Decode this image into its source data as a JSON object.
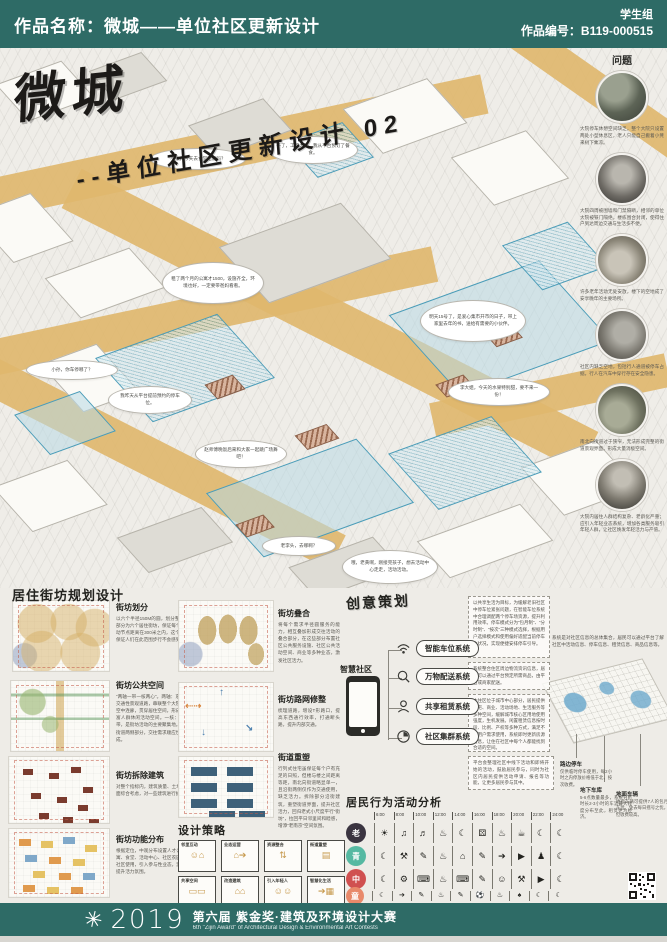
{
  "colors": {
    "header_teal": "#2e6b66",
    "road_tan": "#dfb76e",
    "axon_blue": "#4a9cb8",
    "roof_brown": "#9a6a50"
  },
  "header": {
    "title": "作品名称：微城——单位社区更新设计",
    "group": "学生组",
    "code": "作品编号：B119-000515"
  },
  "title_block": {
    "main": "微城",
    "sub": "--单位社区更新设计 02"
  },
  "bubbles": [
    {
      "text": "小张，今天去食堂吃饭吗？"
    },
    {
      "text": "不了，工作太忙，我从平台预订了餐食。"
    },
    {
      "text": "租了两个月的公寓才1500，设施齐全，环境也好，一定要带爸妈看看。"
    },
    {
      "text": "明天15号了，是爱心集市开市的日子，带上家里去年的书，送给有需要的小伙伴。"
    },
    {
      "text": "小孙，你车停哪了？"
    },
    {
      "text": "我昨天从平台提前预约的停车位。"
    },
    {
      "text": "赵师傅晚饭后来和大家一起跳广场舞吧！"
    },
    {
      "text": "李大姐，今天的水果特别甜，要不来一份！"
    },
    {
      "text": "老李头，去哪啊？"
    },
    {
      "text": "哦，老黄啊，刚接完孩子，想去活动中心走走，活动活动。"
    }
  ],
  "problems": {
    "heading": "问题",
    "items": [
      {
        "caption": "大院停车休憩空间缺乏，整个大院只设置两处小型休息区，老人只能自己搬着小凳来树下乘凉。"
      },
      {
        "caption": "大院四周被围墙和门禁隔断，相邻的单位大院被铁门隔绝，楼栋围合封闭，使得住户到达周边交通与生活多不便。"
      },
      {
        "caption": "许多老年活动无处安放，楼下的空地成了安享晚年的主要场所。"
      },
      {
        "caption": "社区内缺乏空地，包括行人通道被停车占据，行人在汽车中穿行存在安全隐患。"
      },
      {
        "caption": "南北向街道过于狭窄，无法形成完整的街道景观界面，形成大量消极空间。"
      },
      {
        "caption": "大院内居住人群结构复杂、老龄化严重；应引入年轻业态系统，增加各类服务吸引年轻人群，让社区焕发年轻活力与产值。"
      }
    ]
  },
  "planning": {
    "heading": "居住街坊规划设计",
    "sections": [
      {
        "title": "街坊划分",
        "text": "以六个半径150M的圆，划分整个社区内居住部分为六个居住街坊，保证每个街坊内距离活动节点距离在300米之内，这个距离之下，能保证人们在此范围步行不会感到疲惫。"
      },
      {
        "title": "街坊叠合",
        "text": "将每个需求半径圆服务的能力，相互叠加形成交往活动的叠合部分，在这些部分布置社区公共服务设施、社区公共活动空间、商业等多种业态，激发社区活力。"
      },
      {
        "title": "街坊公共空间",
        "text": "“两轴一带一核两心”。两轴：东西向和南北向交通性景观道路，串联整个大院空间。一带：空中连廊，贯穿居住空间，形成慢行通道，丰富人群休闲活动空间。一核：位于街坊中心带，是街坊活动的主要聚集地。两心：位于主街道两侧部分，交往需求顺应世界行为轨迹形成。"
      },
      {
        "title": "街坊路网修整",
        "text": "梳理道路，增设T形路口，提高东西通行效率，打通断头路，提升内部交通。"
      },
      {
        "title": "街坊拆除建筑",
        "text": "对整个指标内，建筑质量、土地使用等多方面综合考虑，对一些建筑进行拆除。"
      },
      {
        "title": "街道重塑",
        "text": "行列式住宅虽保证每个户有充足的日照，但楼与楼之间距离等距，南北向街道略显单一，且沿街两侧仅作为交通使用，缺乏活力。拆除部分沿街建筑，重塑街道界面，提升社区活力，回归老式小尺度平行“街坊”，拉回平日邻里间和睦感，增添“老南京”空间氛围。"
      },
      {
        "title": "街坊功能分布",
        "text": "根据定位，中观分布设置人才公寓、青年公寓、食堂、活动中心、社区农园等功能，供社区使用，引入参与性业态，激发社区自发提升活力氛围。"
      }
    ]
  },
  "strategy": {
    "heading": "设计策略",
    "boxes": [
      {
        "label": "邻里互动",
        "glyph": "☺⌂"
      },
      {
        "label": "业态运营",
        "glyph": "⌂➔"
      },
      {
        "label": "资源整合",
        "glyph": "⇅"
      },
      {
        "label": "街道重塑",
        "glyph": "▤"
      },
      {
        "label": "共享空间",
        "glyph": "▭▭"
      },
      {
        "label": "改造建筑",
        "glyph": "⌂⌂"
      },
      {
        "label": "引入年轻人",
        "glyph": "☺☺"
      },
      {
        "label": "智慧化生活",
        "glyph": "➔▦"
      }
    ]
  },
  "creative": {
    "heading": "创意策划",
    "smart_label": "智慧社区",
    "systems": [
      {
        "label": "智能车位系统"
      },
      {
        "label": "万物配送系统"
      },
      {
        "label": "共享租赁系统"
      },
      {
        "label": "社区集群系统"
      }
    ],
    "notes": [
      {
        "text": "以共享生活为目标，为缓解老旧社区中停车位紧张问题，在智能车位系统中合理调配两个停车场资源，提升利用效率。停车模式分为“包月制”、“分时制”、“按次”三种模式选择，根据用户选择模式和使用偏好适配当前停车位状况，实现便捷安排停车引导。"
      },
      {
        "text": "系统整合住区周边物流资讯信息，居民可以通过平台预定所需商品，由平台或商家配送。"
      },
      {
        "text": "本住区位于城市中心部分，居民提供住宅、商业、活动场地、生活服务等多种空间，缓解城市核心区用地使用强度，生机发展。闲置租赁信息按时段、比例、产权等多种方式，满足不同用户需求使用，系统即时更新房源信息，让住在社区中每个人都能找到合适的空间。"
      },
      {
        "text": "平台会整理社区中线下活动和即将开始的活动，鼓励居民参与，同时为社区内居民提供活动申请、报名等功能，让更多居民参与其中。"
      }
    ],
    "summary": "系统是对社区信息的总体集合，居民可以通过平台了解社区中活动信息、停车信息、租赁信息、商品信息等。",
    "parking": [
      {
        "title": "路边停车",
        "text": "仅供临时停车使用，每2小时之内停放价格低于北，按次收费。"
      },
      {
        "title": "地下车库",
        "text": "5-6点数量最多，系统分析时长2-3小时的车流最大程度分布至此，租赁更为经济。"
      },
      {
        "title": "地面车辆",
        "text": "地面车辆可提供7人的包月车位，免去每日摇号之忧，但收费较高。"
      }
    ]
  },
  "behavior": {
    "heading": "居民行为活动分析",
    "times": [
      "6:00",
      "8:00",
      "10:00",
      "12:00",
      "14:00",
      "16:00",
      "18:00",
      "20:00",
      "22:00",
      "24:00"
    ],
    "rows": [
      {
        "label": "老",
        "color": "#3a3440",
        "icons": [
          {
            "name": "morning-exercise-icon",
            "glyph": "☀"
          },
          {
            "name": "square-dance-icon",
            "glyph": "♫"
          },
          {
            "name": "radio-icon",
            "glyph": "♬"
          },
          {
            "name": "lunch-icon",
            "glyph": "♨"
          },
          {
            "name": "nap-icon",
            "glyph": "☾"
          },
          {
            "name": "mahjong-icon",
            "glyph": "⚄"
          },
          {
            "name": "dinner-icon",
            "glyph": "♨"
          },
          {
            "name": "gathering-icon",
            "glyph": "☕"
          },
          {
            "name": "rest-icon",
            "glyph": "☾"
          },
          {
            "name": "sleep-icon",
            "glyph": "☾"
          }
        ]
      },
      {
        "label": "青",
        "color": "#56b9a2",
        "icons": [
          {
            "name": "sleep-icon",
            "glyph": "☾"
          },
          {
            "name": "work-icon",
            "glyph": "⚒"
          },
          {
            "name": "report-icon",
            "glyph": "✎"
          },
          {
            "name": "lunch-icon",
            "glyph": "♨"
          },
          {
            "name": "office-icon",
            "glyph": "⌂"
          },
          {
            "name": "report-icon",
            "glyph": "✎"
          },
          {
            "name": "scooter-icon",
            "glyph": "➔"
          },
          {
            "name": "tv-icon",
            "glyph": "▶"
          },
          {
            "name": "chess-icon",
            "glyph": "♟"
          },
          {
            "name": "sleep-icon",
            "glyph": "☾"
          }
        ]
      },
      {
        "label": "中",
        "color": "#d05050",
        "icons": [
          {
            "name": "sleep-icon",
            "glyph": "☾"
          },
          {
            "name": "drive-icon",
            "glyph": "⚙"
          },
          {
            "name": "computer-icon",
            "glyph": "⌨"
          },
          {
            "name": "lunch-icon",
            "glyph": "♨"
          },
          {
            "name": "computer-icon",
            "glyph": "⌨"
          },
          {
            "name": "meeting-icon",
            "glyph": "✎"
          },
          {
            "name": "childcare-icon",
            "glyph": "☺"
          },
          {
            "name": "gym-icon",
            "glyph": "⚒"
          },
          {
            "name": "tv-icon",
            "glyph": "▶"
          },
          {
            "name": "sleep-icon",
            "glyph": "☾"
          }
        ]
      },
      {
        "label": "童",
        "color": "#e8896a",
        "icons": [
          {
            "name": "sleep-icon",
            "glyph": "☾"
          },
          {
            "name": "run-icon",
            "glyph": "➔"
          },
          {
            "name": "book-icon",
            "glyph": "✎"
          },
          {
            "name": "lunch-icon",
            "glyph": "♨"
          },
          {
            "name": "book-icon",
            "glyph": "✎"
          },
          {
            "name": "football-icon",
            "glyph": "⚽"
          },
          {
            "name": "dinner-icon",
            "glyph": "♨"
          },
          {
            "name": "game-icon",
            "glyph": "♠"
          },
          {
            "name": "sleep-icon",
            "glyph": "☾"
          },
          {
            "name": "sleep-icon",
            "glyph": "☾"
          }
        ]
      }
    ]
  },
  "footer": {
    "logo_glyph": "✳",
    "year": "2019",
    "title": "第六届 紫金奖·建筑及环境设计大赛",
    "subtitle": "6th \"Zijin Award\" of Architectural Design & Environmental Art Contests"
  }
}
